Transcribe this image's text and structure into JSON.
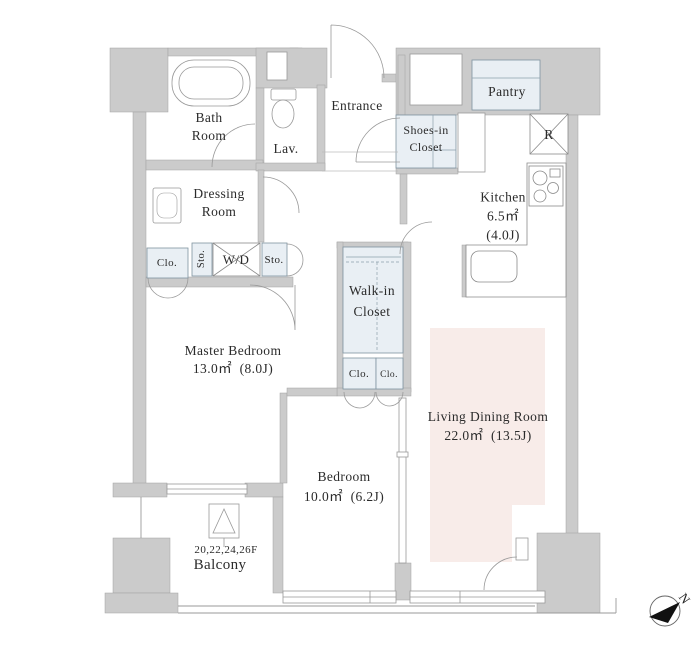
{
  "colors": {
    "wall": "#cbcbcb",
    "closet_fill": "#e9eff4",
    "living_highlight": "#f8ece9",
    "line": "#999999"
  },
  "rooms": {
    "bath": {
      "line1": "Bath",
      "line2": "Room"
    },
    "lavatory": {
      "label": "Lav."
    },
    "entrance": {
      "label": "Entrance"
    },
    "shoes_closet": {
      "line1": "Shoes-in",
      "line2": "Closet"
    },
    "pantry": {
      "label": "Pantry"
    },
    "refrigerator": {
      "label": "R"
    },
    "kitchen": {
      "name": "Kitchen",
      "area": "6.5㎡",
      "tatami": "(4.0J)"
    },
    "dressing": {
      "line1": "Dressing",
      "line2": "Room"
    },
    "closet1": {
      "label": "Clo."
    },
    "storage1": {
      "label": "Sto."
    },
    "washer_dryer": {
      "label": "W/D"
    },
    "storage2": {
      "label": "Sto."
    },
    "walkin_closet": {
      "line1": "Walk-in",
      "line2": "Closet"
    },
    "master_bedroom": {
      "name": "Master Bedroom",
      "size": "13.0㎡  (8.0J)"
    },
    "closet2": {
      "label": "Clo."
    },
    "closet3": {
      "label": "Clo."
    },
    "living_dining": {
      "name": "Living Dining Room",
      "size": "22.0㎡  (13.5J)"
    },
    "bedroom": {
      "name": "Bedroom",
      "size": "10.0㎡  (6.2J)"
    },
    "balcony": {
      "floors": "20,22,24,26F",
      "name": "Balcony"
    }
  },
  "compass": {
    "label": "N"
  }
}
